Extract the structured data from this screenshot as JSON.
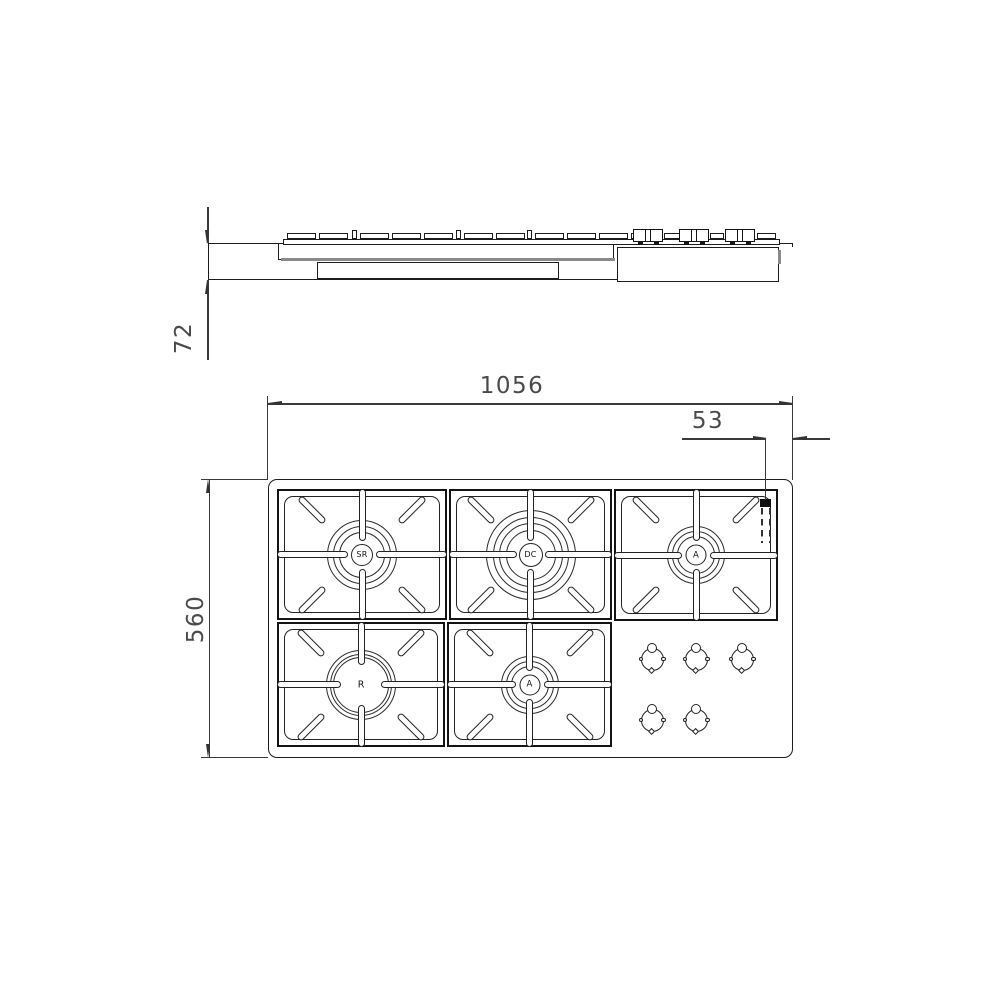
{
  "drawing": {
    "type": "technical-dimension-drawing",
    "views": {
      "side_view": "cooktop side elevation",
      "top_view": "cooktop plan with burners and controls"
    },
    "colors": {
      "background": "#ffffff",
      "line": "#1d1d1d",
      "dimension": "#4a4a4a",
      "shadow": "#8a8a8a"
    }
  },
  "dimensions": {
    "overall_width": "1056",
    "overall_depth": "560",
    "body_height": "72",
    "right_offset": "53"
  },
  "burners": [
    {
      "label": "SR"
    },
    {
      "label": "DC"
    },
    {
      "label": "A"
    },
    {
      "label": "R"
    },
    {
      "label": "A"
    }
  ]
}
